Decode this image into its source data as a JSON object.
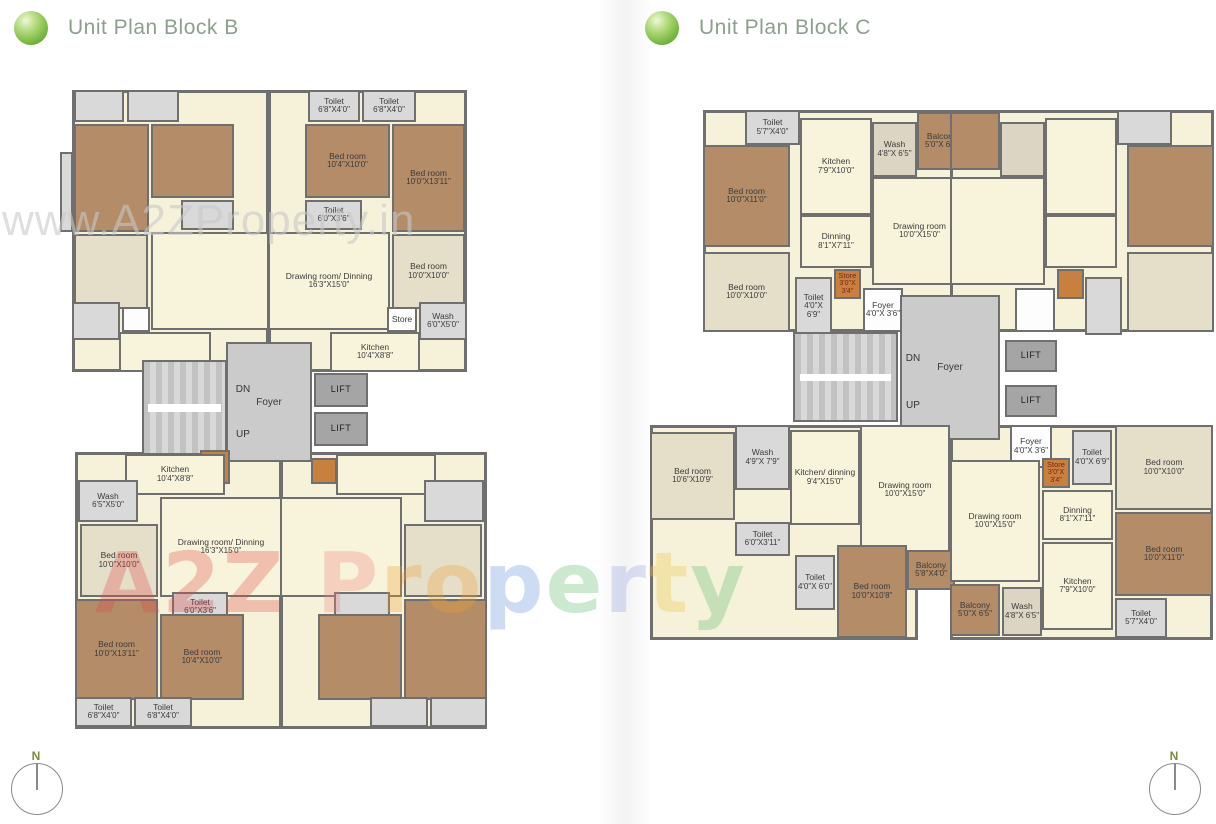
{
  "page": {
    "header_b": {
      "title": "Unit Plan Block B"
    },
    "header_c": {
      "title": "Unit Plan Block C"
    },
    "compass": {
      "label": "N"
    },
    "watermark_top": "www.A2ZProperty.in",
    "watermark_letters": [
      {
        "ch": "A",
        "color": "#e04848"
      },
      {
        "ch": "2",
        "color": "#e04848"
      },
      {
        "ch": "Z",
        "color": "#e04848"
      },
      {
        "ch": " "
      },
      {
        "ch": "P",
        "color": "#ef8080"
      },
      {
        "ch": "r",
        "color": "#f0a030"
      },
      {
        "ch": "o",
        "color": "#f0a030"
      },
      {
        "ch": "p",
        "color": "#5b8dd9"
      },
      {
        "ch": "e",
        "color": "#58b868"
      },
      {
        "ch": "r",
        "color": "#8fa0dd"
      },
      {
        "ch": "t",
        "color": "#ecc53c"
      },
      {
        "ch": "y",
        "color": "#58b868"
      }
    ],
    "colors": {
      "accent_green": "#7fbf4d",
      "title_text": "#8d9f8d",
      "wall": "#6f6f6f",
      "living_cream": "#f8f4dc",
      "bedroom_brown": "#b48c68",
      "bedroom_beige": "#e5dfc9",
      "toilet_gray": "#d9d9d9",
      "foyer_gray": "#cbcbcb",
      "lift_gray": "#a5a5a5",
      "store_orange": "#c8803f"
    }
  },
  "plan_b": {
    "rooms": [
      {
        "n": "unit-base",
        "c": "base",
        "x": 12,
        "y": 5,
        "w": 197,
        "h": 282
      },
      {
        "n": "unit-base",
        "c": "base",
        "x": 208,
        "y": 5,
        "w": 199,
        "h": 282
      },
      {
        "n": "unit-base",
        "c": "base",
        "x": 15,
        "y": 367,
        "w": 207,
        "h": 277
      },
      {
        "n": "unit-base",
        "c": "base",
        "x": 220,
        "y": 367,
        "w": 207,
        "h": 277
      },
      {
        "n": "balcony",
        "c": "gray",
        "x": 0,
        "y": 67,
        "w": 13,
        "h": 80
      },
      {
        "n": "toilet-room",
        "c": "gray",
        "x": 14,
        "y": 5,
        "w": 50,
        "h": 32
      },
      {
        "n": "toilet-room",
        "c": "gray",
        "x": 67,
        "y": 5,
        "w": 52,
        "h": 32
      },
      {
        "n": "bedroom",
        "c": "brown",
        "x": 14,
        "y": 39,
        "w": 75,
        "h": 108
      },
      {
        "n": "bedroom",
        "c": "brown",
        "x": 91,
        "y": 39,
        "w": 83,
        "h": 74
      },
      {
        "n": "toilet-room",
        "c": "gray",
        "x": 121,
        "y": 115,
        "w": 53,
        "h": 30
      },
      {
        "n": "bedroom",
        "c": "beige",
        "x": 14,
        "y": 149,
        "w": 74,
        "h": 75
      },
      {
        "n": "drawing-room",
        "c": "cream",
        "x": 91,
        "y": 147,
        "w": 118,
        "h": 98
      },
      {
        "n": "wash-room",
        "c": "gray",
        "x": 12,
        "y": 217,
        "w": 48,
        "h": 38
      },
      {
        "n": "store-room",
        "c": "white",
        "x": 62,
        "y": 222,
        "w": 28,
        "h": 25
      },
      {
        "n": "kitchen",
        "c": "cream",
        "x": 59,
        "y": 247,
        "w": 92,
        "h": 40
      },
      {
        "n": "toilet-room",
        "c": "gray",
        "l": "Toilet",
        "d": "6'8\"X4'0\"",
        "x": 248,
        "y": 5,
        "w": 52,
        "h": 32
      },
      {
        "n": "toilet-room",
        "c": "gray",
        "l": "Toilet",
        "d": "6'8\"X4'0\"",
        "x": 302,
        "y": 5,
        "w": 54,
        "h": 32
      },
      {
        "n": "bedroom",
        "c": "brown",
        "l": "Bed room",
        "d": "10'4\"X10'0\"",
        "x": 245,
        "y": 39,
        "w": 85,
        "h": 74
      },
      {
        "n": "bedroom",
        "c": "brown",
        "l": "Bed room",
        "d": "10'0\"X13'11\"",
        "x": 332,
        "y": 39,
        "w": 73,
        "h": 108
      },
      {
        "n": "toilet-room",
        "c": "gray",
        "l": "Toilet",
        "d": "6'0\"X3'6\"",
        "x": 245,
        "y": 115,
        "w": 57,
        "h": 30
      },
      {
        "n": "bedroom",
        "c": "beige",
        "l": "Bed room",
        "d": "10'0\"X10'0\"",
        "x": 332,
        "y": 149,
        "w": 73,
        "h": 75
      },
      {
        "n": "drawing-room",
        "c": "cream",
        "l": "Drawing room/ Dinning",
        "d": "16'3\"X15'0\"",
        "x": 208,
        "y": 147,
        "w": 122,
        "h": 98
      },
      {
        "n": "store-room",
        "c": "white",
        "l": "Store",
        "x": 327,
        "y": 222,
        "w": 30,
        "h": 25
      },
      {
        "n": "wash-room",
        "c": "gray",
        "l": "Wash",
        "d": "6'0\"X5'0\"",
        "x": 359,
        "y": 217,
        "w": 48,
        "h": 38
      },
      {
        "n": "kitchen",
        "c": "cream",
        "l": "Kitchen",
        "d": "10'4\"X8'8\"",
        "x": 270,
        "y": 247,
        "w": 90,
        "h": 40
      },
      {
        "n": "stairs",
        "c": "stairs",
        "x": 82,
        "y": 275,
        "w": 85,
        "h": 95
      },
      {
        "n": "foyer",
        "c": "foyer",
        "l": "Foyer",
        "x": 166,
        "y": 257,
        "w": 86,
        "h": 120
      },
      {
        "n": "lift",
        "c": "lift",
        "l": "LIFT",
        "x": 254,
        "y": 288,
        "w": 54,
        "h": 34
      },
      {
        "n": "lift",
        "c": "lift",
        "l": "LIFT",
        "x": 254,
        "y": 327,
        "w": 54,
        "h": 34
      },
      {
        "n": "store-room",
        "c": "store",
        "l": "Store",
        "d": "3'6\"X 3'8\"",
        "x": 140,
        "y": 365,
        "w": 30,
        "h": 34
      },
      {
        "n": "dn-label",
        "c": "plain",
        "l": "DN",
        "x": 170,
        "y": 298,
        "w": 26,
        "h": 13
      },
      {
        "n": "up-label",
        "c": "plain",
        "l": "UP",
        "x": 170,
        "y": 343,
        "w": 26,
        "h": 13
      },
      {
        "n": "kitchen",
        "c": "cream",
        "l": "Kitchen",
        "d": "10'4\"X8'8\"",
        "x": 65,
        "y": 369,
        "w": 100,
        "h": 41
      },
      {
        "n": "wash-room",
        "c": "gray",
        "l": "Wash",
        "d": "6'5\"X5'0\"",
        "x": 18,
        "y": 395,
        "w": 60,
        "h": 42
      },
      {
        "n": "bedroom",
        "c": "beige",
        "l": "Bed room",
        "d": "10'0\"X10'0\"",
        "x": 20,
        "y": 439,
        "w": 78,
        "h": 73
      },
      {
        "n": "drawing-room",
        "c": "cream",
        "l": "Drawing room/ Dinning",
        "d": "16'3\"X15'0\"",
        "x": 100,
        "y": 412,
        "w": 122,
        "h": 100
      },
      {
        "n": "toilet-room",
        "c": "gray",
        "l": "Toilet",
        "d": "6'0\"X3'6\"",
        "x": 112,
        "y": 507,
        "w": 56,
        "h": 30
      },
      {
        "n": "bedroom",
        "c": "brown",
        "l": "Bed room",
        "d": "10'0\"X13'11\"",
        "x": 15,
        "y": 514,
        "w": 83,
        "h": 101
      },
      {
        "n": "bedroom",
        "c": "brown",
        "l": "Bed room",
        "d": "10'4\"X10'0\"",
        "x": 100,
        "y": 529,
        "w": 84,
        "h": 86
      },
      {
        "n": "toilet-room",
        "c": "gray",
        "l": "Toilet",
        "d": "6'8\"X4'0\"",
        "x": 15,
        "y": 612,
        "w": 57,
        "h": 30
      },
      {
        "n": "toilet-room",
        "c": "gray",
        "l": "Toilet",
        "d": "6'8\"X4'0\"",
        "x": 74,
        "y": 612,
        "w": 58,
        "h": 30
      },
      {
        "n": "kitchen",
        "c": "cream",
        "x": 276,
        "y": 369,
        "w": 100,
        "h": 41
      },
      {
        "n": "store-room",
        "c": "store",
        "x": 251,
        "y": 373,
        "w": 26,
        "h": 26
      },
      {
        "n": "wash-room",
        "c": "gray",
        "x": 364,
        "y": 395,
        "w": 60,
        "h": 42
      },
      {
        "n": "bedroom",
        "c": "beige",
        "x": 344,
        "y": 439,
        "w": 78,
        "h": 73
      },
      {
        "n": "drawing-room",
        "c": "cream",
        "x": 220,
        "y": 412,
        "w": 122,
        "h": 100
      },
      {
        "n": "toilet-room",
        "c": "gray",
        "x": 274,
        "y": 507,
        "w": 56,
        "h": 30
      },
      {
        "n": "bedroom",
        "c": "brown",
        "x": 344,
        "y": 514,
        "w": 83,
        "h": 101
      },
      {
        "n": "bedroom",
        "c": "brown",
        "x": 258,
        "y": 529,
        "w": 84,
        "h": 86
      },
      {
        "n": "toilet-room",
        "c": "gray",
        "x": 310,
        "y": 612,
        "w": 58,
        "h": 30
      },
      {
        "n": "toilet-room",
        "c": "gray",
        "x": 370,
        "y": 612,
        "w": 57,
        "h": 30
      }
    ]
  },
  "plan_c": {
    "rooms": [
      {
        "n": "unit-base",
        "c": "base",
        "x": 58,
        "y": 10,
        "w": 264,
        "h": 222
      },
      {
        "n": "unit-base",
        "c": "base",
        "x": 305,
        "y": 10,
        "w": 264,
        "h": 222
      },
      {
        "n": "unit-base",
        "c": "base",
        "x": 5,
        "y": 325,
        "w": 268,
        "h": 215
      },
      {
        "n": "unit-base",
        "c": "base",
        "x": 305,
        "y": 325,
        "w": 263,
        "h": 215
      },
      {
        "n": "toilet-room",
        "c": "gray",
        "l": "Toilet",
        "d": "5'7\"X4'0\"",
        "x": 100,
        "y": 10,
        "w": 55,
        "h": 35
      },
      {
        "n": "kitchen",
        "c": "cream",
        "l": "Kitchen",
        "d": "7'9\"X10'0\"",
        "x": 155,
        "y": 18,
        "w": 72,
        "h": 97
      },
      {
        "n": "wash-room",
        "c": "washc",
        "l": "Wash",
        "d": "4'8\"X 6'5\"",
        "x": 227,
        "y": 22,
        "w": 45,
        "h": 55
      },
      {
        "n": "balcony",
        "c": "brown",
        "l": "Balcony",
        "d": "5'0\"X 6'5\"",
        "x": 272,
        "y": 12,
        "w": 50,
        "h": 58
      },
      {
        "n": "bedroom",
        "c": "brown",
        "l": "Bed room",
        "d": "10'0\"X11'0\"",
        "x": 58,
        "y": 45,
        "w": 87,
        "h": 102
      },
      {
        "n": "dinning",
        "c": "cream",
        "l": "Dinning",
        "d": "8'1\"X7'11\"",
        "x": 155,
        "y": 115,
        "w": 72,
        "h": 53
      },
      {
        "n": "drawing-room",
        "c": "cream",
        "l": "Drawing room",
        "d": "10'0\"X15'0\"",
        "x": 227,
        "y": 77,
        "w": 95,
        "h": 108
      },
      {
        "n": "bedroom",
        "c": "beige",
        "l": "Bed room",
        "d": "10'0\"X10'0\"",
        "x": 58,
        "y": 152,
        "w": 87,
        "h": 80
      },
      {
        "n": "toilet-room",
        "c": "gray",
        "l": "Toilet",
        "d": "4'0\"X 6'9\"",
        "x": 150,
        "y": 177,
        "w": 37,
        "h": 58
      },
      {
        "n": "store-room",
        "c": "store",
        "l": "Store",
        "d": "3'0\"X 3'4\"",
        "x": 189,
        "y": 169,
        "w": 27,
        "h": 30
      },
      {
        "n": "foyer-small",
        "c": "white",
        "l": "Foyer",
        "d": "4'0\"X 3'6\"",
        "x": 218,
        "y": 188,
        "w": 40,
        "h": 44
      },
      {
        "n": "toilet-room",
        "c": "gray",
        "x": 472,
        "y": 10,
        "w": 55,
        "h": 35
      },
      {
        "n": "kitchen",
        "c": "cream",
        "x": 400,
        "y": 18,
        "w": 72,
        "h": 97
      },
      {
        "n": "wash-room",
        "c": "washc",
        "x": 355,
        "y": 22,
        "w": 45,
        "h": 55
      },
      {
        "n": "balcony",
        "c": "brown",
        "x": 305,
        "y": 12,
        "w": 50,
        "h": 58
      },
      {
        "n": "bedroom",
        "c": "brown",
        "x": 482,
        "y": 45,
        "w": 87,
        "h": 102
      },
      {
        "n": "bedroom",
        "c": "beige",
        "x": 482,
        "y": 152,
        "w": 87,
        "h": 80
      },
      {
        "n": "drawing-room",
        "c": "cream",
        "x": 305,
        "y": 77,
        "w": 95,
        "h": 108
      },
      {
        "n": "dinning",
        "c": "cream",
        "x": 400,
        "y": 115,
        "w": 72,
        "h": 53
      },
      {
        "n": "toilet-room",
        "c": "gray",
        "x": 440,
        "y": 177,
        "w": 37,
        "h": 58
      },
      {
        "n": "store-room",
        "c": "store",
        "x": 412,
        "y": 169,
        "w": 27,
        "h": 30
      },
      {
        "n": "foyer-small",
        "c": "white",
        "x": 370,
        "y": 188,
        "w": 40,
        "h": 44
      },
      {
        "n": "stairs",
        "c": "stairs",
        "x": 148,
        "y": 232,
        "w": 105,
        "h": 90
      },
      {
        "n": "foyer",
        "c": "foyer",
        "l": "Foyer",
        "x": 255,
        "y": 195,
        "w": 100,
        "h": 145
      },
      {
        "n": "dn-label",
        "c": "plain",
        "l": "DN",
        "x": 255,
        "y": 252,
        "w": 26,
        "h": 13
      },
      {
        "n": "up-label",
        "c": "plain",
        "l": "UP",
        "x": 255,
        "y": 299,
        "w": 26,
        "h": 13
      },
      {
        "n": "lift",
        "c": "lift",
        "l": "LIFT",
        "x": 360,
        "y": 240,
        "w": 52,
        "h": 32
      },
      {
        "n": "lift",
        "c": "lift",
        "l": "LIFT",
        "x": 360,
        "y": 285,
        "w": 52,
        "h": 32
      },
      {
        "n": "wash-room",
        "c": "gray",
        "l": "Wash",
        "d": "4'9\"X 7'9\"",
        "x": 90,
        "y": 325,
        "w": 55,
        "h": 65
      },
      {
        "n": "bedroom",
        "c": "beige",
        "l": "Bed room",
        "d": "10'6\"X10'9\"",
        "x": 5,
        "y": 332,
        "w": 85,
        "h": 88
      },
      {
        "n": "kitchen",
        "c": "cream",
        "l": "Kitchen/ dinning",
        "d": "9'4\"X15'0\"",
        "x": 145,
        "y": 330,
        "w": 70,
        "h": 95
      },
      {
        "n": "drawing-room",
        "c": "cream",
        "l": "Drawing room",
        "d": "10'0\"X15'0\"",
        "x": 215,
        "y": 325,
        "w": 90,
        "h": 130
      },
      {
        "n": "toilet-room",
        "c": "gray",
        "l": "Toilet",
        "d": "6'0\"X3'11\"",
        "x": 90,
        "y": 422,
        "w": 55,
        "h": 34
      },
      {
        "n": "toilet-room",
        "c": "gray",
        "l": "Toilet",
        "d": "4'0\"X 6'0\"",
        "x": 150,
        "y": 455,
        "w": 40,
        "h": 55
      },
      {
        "n": "bedroom",
        "c": "brown",
        "l": "Bed room",
        "d": "10'0\"X10'8\"",
        "x": 192,
        "y": 445,
        "w": 70,
        "h": 93
      },
      {
        "n": "balcony",
        "c": "brown",
        "l": "Balcony",
        "d": "5'8\"X4'0\"",
        "x": 262,
        "y": 450,
        "w": 48,
        "h": 40
      },
      {
        "n": "foyer-small",
        "c": "white",
        "l": "Foyer",
        "d": "4'0\"X 3'6\"",
        "x": 365,
        "y": 325,
        "w": 42,
        "h": 43
      },
      {
        "n": "store-room",
        "c": "store",
        "l": "Store",
        "d": "3'0\"X 3'4\"",
        "x": 397,
        "y": 358,
        "w": 28,
        "h": 30
      },
      {
        "n": "toilet-room",
        "c": "gray",
        "l": "Toilet",
        "d": "4'0\"X 6'9\"",
        "x": 427,
        "y": 330,
        "w": 40,
        "h": 55
      },
      {
        "n": "bedroom",
        "c": "beige",
        "l": "Bed room",
        "d": "10'0\"X10'0\"",
        "x": 470,
        "y": 325,
        "w": 98,
        "h": 85
      },
      {
        "n": "dinning",
        "c": "cream",
        "l": "Dinning",
        "d": "8'1\"X7'11\"",
        "x": 397,
        "y": 390,
        "w": 71,
        "h": 50
      },
      {
        "n": "drawing-room",
        "c": "cream",
        "l": "Drawing room",
        "d": "10'0\"X15'0\"",
        "x": 305,
        "y": 360,
        "w": 90,
        "h": 122
      },
      {
        "n": "bedroom",
        "c": "brown",
        "l": "Bed room",
        "d": "10'0\"X11'0\"",
        "x": 470,
        "y": 412,
        "w": 98,
        "h": 84
      },
      {
        "n": "kitchen",
        "c": "cream",
        "l": "Kitchen",
        "d": "7'9\"X10'0\"",
        "x": 397,
        "y": 442,
        "w": 71,
        "h": 88
      },
      {
        "n": "balcony",
        "c": "brown",
        "l": "Balcony",
        "d": "5'0\"X 6'5\"",
        "x": 305,
        "y": 484,
        "w": 50,
        "h": 52
      },
      {
        "n": "wash-room",
        "c": "washc",
        "l": "Wash",
        "d": "4'8\"X 6'5\"",
        "x": 357,
        "y": 487,
        "w": 40,
        "h": 49
      },
      {
        "n": "toilet-room",
        "c": "gray",
        "l": "Toilet",
        "d": "5'7\"X4'0\"",
        "x": 470,
        "y": 498,
        "w": 52,
        "h": 40
      }
    ]
  }
}
